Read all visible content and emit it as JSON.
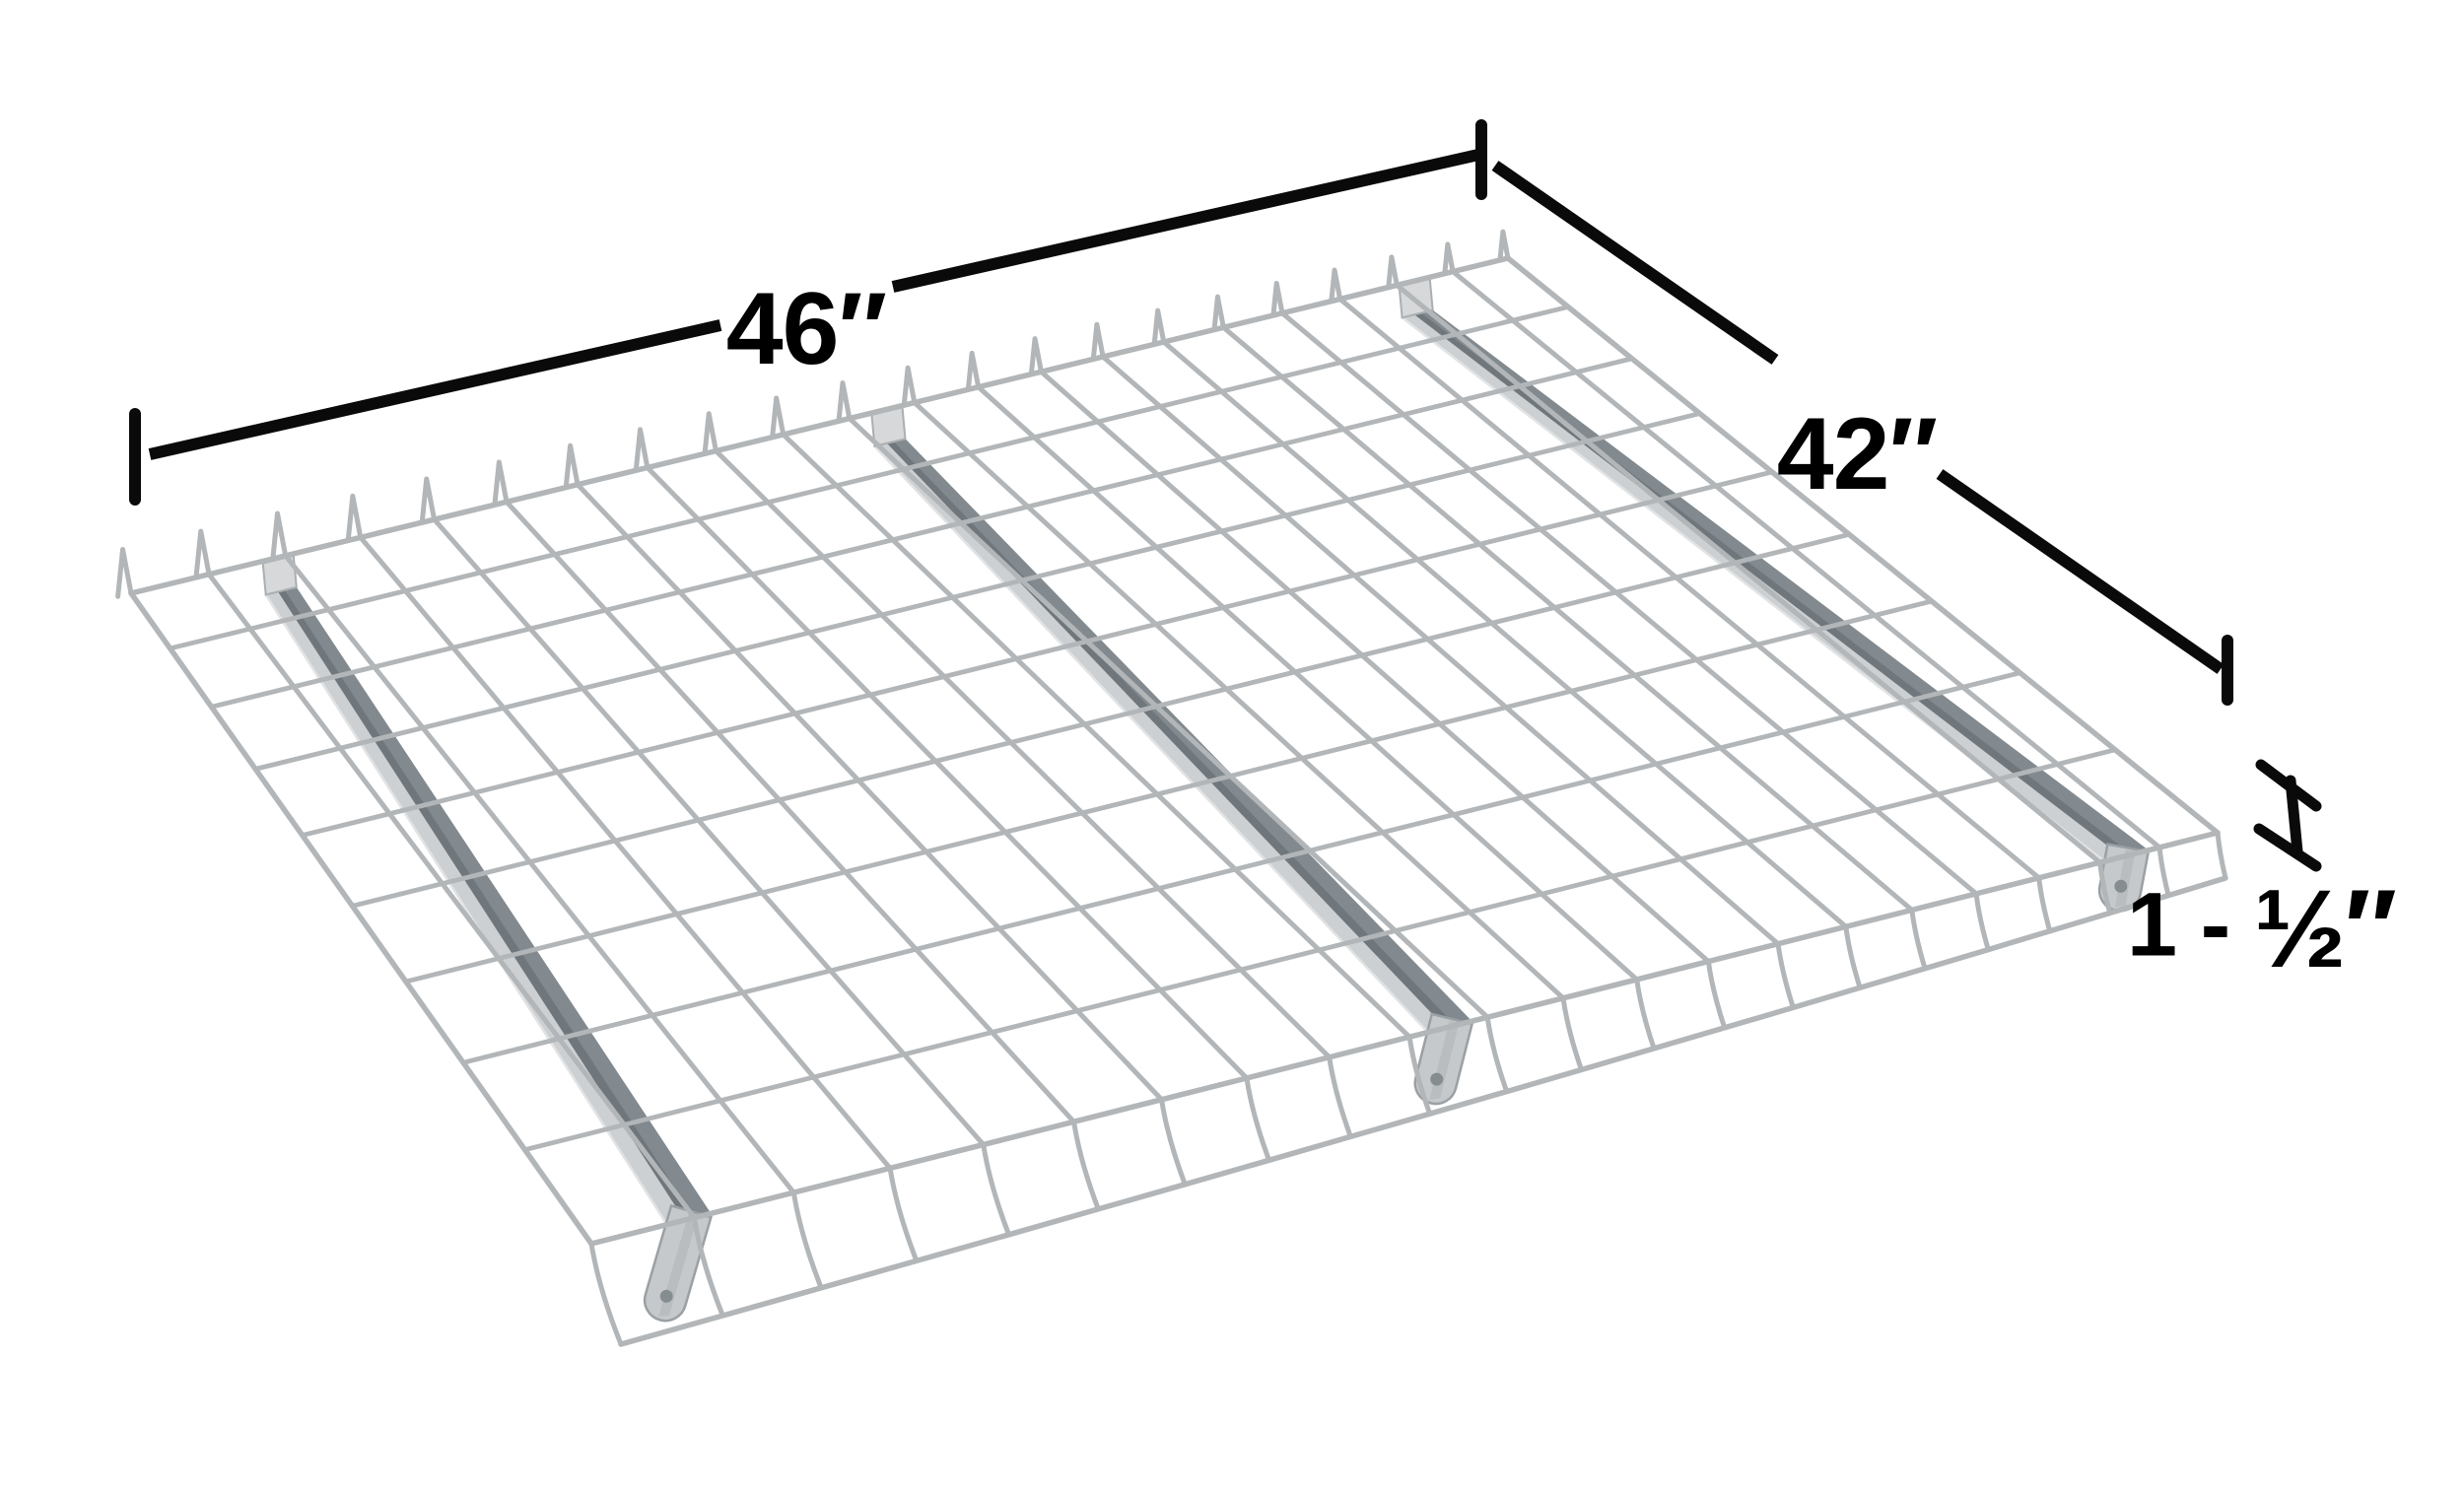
{
  "title": "Wire mesh deck panel dimension diagram",
  "annotations": {
    "width": {
      "label": "46″"
    },
    "depth": {
      "label": "42″"
    },
    "height": {
      "prefix": "1 - ",
      "fraction": "½″",
      "full_label": "1 - ½″"
    }
  },
  "deck": {
    "description": "galvanized wire mesh decking panel with waterfall back loops and front lip",
    "grid_columns": 21,
    "grid_rows": 9,
    "support_channels": 3
  },
  "colors": {
    "background": "#ffffff",
    "dimension_line": "#0a0a0a",
    "wire": "#b2b6b8",
    "wire_light": "#c6c9cb",
    "channel_flange": "#cdd0d2",
    "channel_web_shadow": "#828a8f",
    "channel_web_dark": "#6f777c",
    "channel_edge": "#9aa0a4",
    "channel_endcap": "#d6d8d9",
    "channel_hole": "#868d91"
  }
}
